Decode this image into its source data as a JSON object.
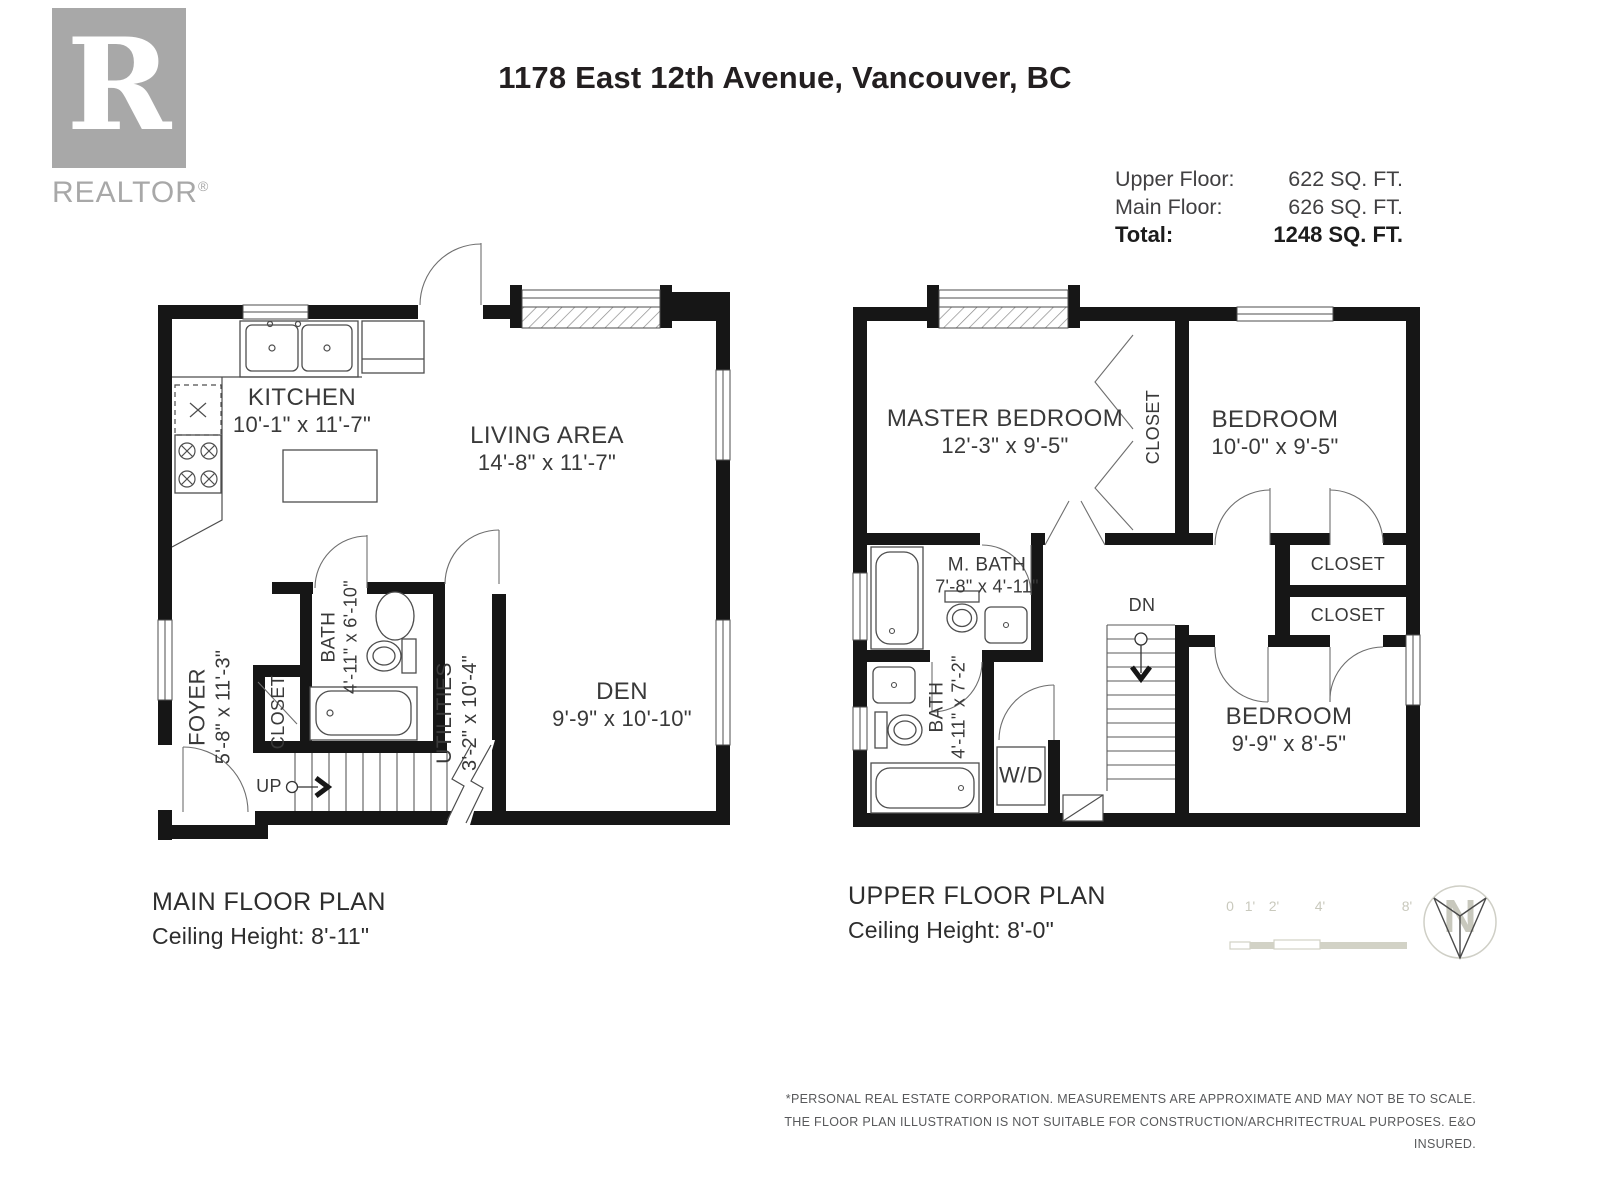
{
  "logo": {
    "mark": "R",
    "brand": "REALTOR",
    "registered": "®"
  },
  "header": {
    "title": "1178 East 12th Avenue, Vancouver, BC"
  },
  "areas": {
    "rows": [
      {
        "label": "Upper Floor:",
        "value": "622 SQ. FT."
      },
      {
        "label": "Main Floor:",
        "value": "626 SQ. FT."
      },
      {
        "label": "Total:",
        "value": "1248 SQ. FT."
      }
    ]
  },
  "main_floor": {
    "title": "MAIN FLOOR PLAN",
    "ceiling": "Ceiling Height: 8'-11\"",
    "up_label": "UP",
    "rooms": {
      "kitchen": {
        "name": "KITCHEN",
        "dims": "10'-1\" x 11'-7\""
      },
      "living": {
        "name": "LIVING AREA",
        "dims": "14'-8\" x 11'-7\""
      },
      "den": {
        "name": "DEN",
        "dims": "9'-9\" x 10'-10\""
      },
      "foyer": {
        "name": "FOYER",
        "dims": "5'-8\" x 11'-3\""
      },
      "closet": {
        "name": "CLOSET"
      },
      "bath": {
        "name": "BATH",
        "dims": "4'-11\" x 6'-10\""
      },
      "utilities": {
        "name": "UTILITIES",
        "dims": "3'-2\" x 10'-4\""
      }
    }
  },
  "upper_floor": {
    "title": "UPPER FLOOR PLAN",
    "ceiling": "Ceiling Height: 8'-0\"",
    "dn_label": "DN",
    "wd_label": "W/D",
    "rooms": {
      "master": {
        "name": "MASTER BEDROOM",
        "dims": "12'-3\" x 9'-5\""
      },
      "master_closet": {
        "name": "CLOSET"
      },
      "bedroom2": {
        "name": "BEDROOM",
        "dims": "10'-0\" x 9'-5\""
      },
      "mbath": {
        "name": "M. BATH",
        "dims": "7'-8\" x 4'-11\""
      },
      "bath": {
        "name": "BATH",
        "dims": "4'-11\" x 7'-2\""
      },
      "closet1": {
        "name": "CLOSET"
      },
      "closet2": {
        "name": "CLOSET"
      },
      "bedroom3": {
        "name": "BEDROOM",
        "dims": "9'-9\" x 8'-5\""
      }
    }
  },
  "scale_bar": {
    "ticks": [
      "0",
      "1'",
      "2'",
      "4'",
      "8'"
    ]
  },
  "north": {
    "label": "N"
  },
  "disclaimer": {
    "line1": "*PERSONAL REAL ESTATE CORPORATION. MEASUREMENTS ARE APPROXIMATE AND MAY NOT BE TO SCALE.",
    "line2": "THE FLOOR PLAN ILLUSTRATION IS NOT SUITABLE FOR CONSTRUCTION/ARCHRITECTRUAL PURPOSES. E&O INSURED."
  }
}
